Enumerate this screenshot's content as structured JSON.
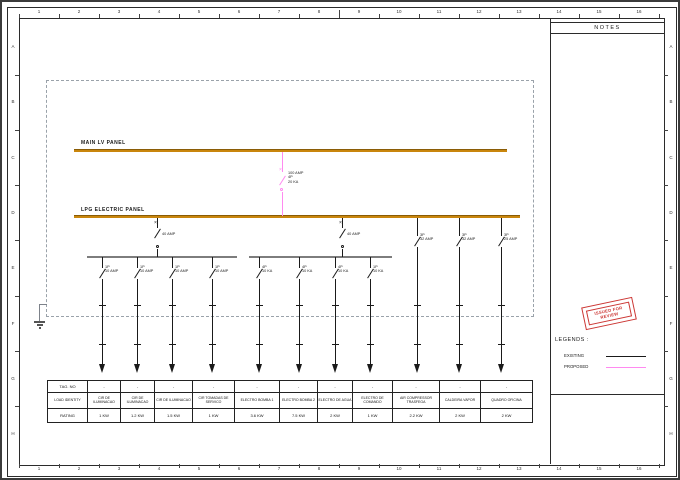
{
  "colors": {
    "bus": "#c9860d",
    "existing": "#1a1a1a",
    "proposed": "#ff8af0",
    "stamp_red": "#cc3633",
    "boundary_gray": "#9aa2aa",
    "sub_bus_gray": "#7d7d7d"
  },
  "ruler": {
    "top_numbers": [
      "1",
      "2",
      "3",
      "4",
      "5",
      "6",
      "7",
      "8",
      "9",
      "10",
      "11",
      "12",
      "13",
      "14",
      "15",
      "16"
    ],
    "bottom_numbers": [
      "1",
      "2",
      "3",
      "4",
      "5",
      "6",
      "7",
      "8",
      "9",
      "10",
      "11",
      "12",
      "13",
      "14",
      "15",
      "16"
    ],
    "left_letters": [
      "A",
      "B",
      "C",
      "D",
      "E",
      "F",
      "G",
      "H"
    ],
    "right_letters": [
      "A",
      "B",
      "C",
      "D",
      "E",
      "F",
      "G",
      "H"
    ]
  },
  "notes": {
    "title": "NOTES"
  },
  "stamp": {
    "line1": "ISSUED FOR",
    "line2": "REVIEW"
  },
  "legends": {
    "title": "LEGENDS :",
    "items": [
      {
        "label": "EXISTING",
        "color": "#1a1a1a"
      },
      {
        "label": "PROPOSED",
        "color": "#ff8af0"
      }
    ]
  },
  "panels": {
    "main": "MAIN LV PANEL",
    "lpg": "LPG ELECTRIC PANEL"
  },
  "main_breaker": {
    "line1": "100 AMP",
    "line2": "4P",
    "line3": "20 KA"
  },
  "feed_breakers": [
    {
      "rating": "40 AMP"
    },
    {
      "rating": "40 AMP"
    }
  ],
  "branches": [
    {
      "poles": "1P",
      "rating": "10 AMP"
    },
    {
      "poles": "1P",
      "rating": "10 AMP"
    },
    {
      "poles": "1P",
      "rating": "10 AMP"
    },
    {
      "poles": "1P",
      "rating": "10 AMP"
    },
    {
      "poles": "4P",
      "rating": "10 KA"
    },
    {
      "poles": "4P",
      "rating": "10 KA"
    },
    {
      "poles": "4P",
      "rating": "10 KA"
    },
    {
      "poles": "1P",
      "rating": "10 KA"
    },
    {
      "poles": "3P",
      "rating": "32 AMP"
    },
    {
      "poles": "3P",
      "rating": "32 AMP"
    },
    {
      "poles": "3P",
      "rating": "25 AMP"
    }
  ],
  "table": {
    "row_headers": [
      "TAG. NO",
      "LOAD IDENTITY",
      "RATING"
    ],
    "columns": [
      {
        "tag": "-",
        "identity": "CIR DE ILUMINACAO",
        "rating": "1 KW"
      },
      {
        "tag": "-",
        "identity": "CIR DE ILUMINACAO",
        "rating": "1.2 KW"
      },
      {
        "tag": "-",
        "identity": "CIR DE ILUMINACAO",
        "rating": "1.5 KW"
      },
      {
        "tag": "-",
        "identity": "CIR TOMADAS DE SERVICO",
        "rating": "1 KW"
      },
      {
        "tag": "-",
        "identity": "ELECTRO BOMBA 1",
        "rating": "3.6 KW"
      },
      {
        "tag": "-",
        "identity": "ELECTRO BOMBA 2",
        "rating": "7.5 KW"
      },
      {
        "tag": "-",
        "identity": "ELECTRO DE AGUA",
        "rating": "2 KW"
      },
      {
        "tag": "-",
        "identity": "ELECTRO DE COMANDO",
        "rating": "1 KW"
      },
      {
        "tag": "-",
        "identity": "AIR COMPRESSOR TRASFEGA",
        "rating": "2.2 KW"
      },
      {
        "tag": "-",
        "identity": "CALDEIRA VAPOR",
        "rating": "2 KW"
      },
      {
        "tag": "-",
        "identity": "QUADRO OFICINA",
        "rating": "2 KW"
      }
    ]
  }
}
